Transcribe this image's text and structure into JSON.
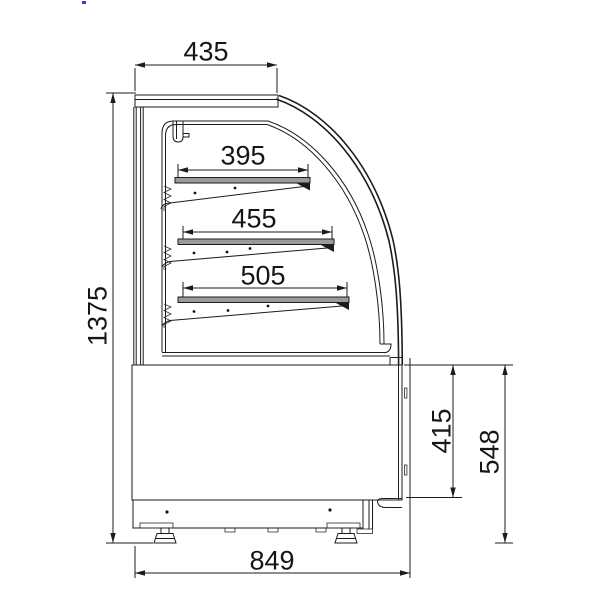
{
  "drawing": {
    "title": "display-cabinet-side-elevation",
    "description": "Technical side-view line drawing of a curved-glass refrigerated display cabinet with three shelves, base body, plinth and adjustable feet, fully dimensioned",
    "units_implied": "mm",
    "dimensions": {
      "top_depth": {
        "label": "435",
        "orientation": "horizontal",
        "location": "top of canopy"
      },
      "shelf_top": {
        "label": "395",
        "orientation": "horizontal",
        "location": "upper shelf depth"
      },
      "shelf_middle": {
        "label": "455",
        "orientation": "horizontal",
        "location": "middle shelf depth"
      },
      "shelf_bottom": {
        "label": "505",
        "orientation": "horizontal",
        "location": "lower shelf depth"
      },
      "overall_height": {
        "label": "1375",
        "orientation": "vertical",
        "location": "left side overall height"
      },
      "body_inner_height": {
        "label": "415",
        "orientation": "vertical",
        "location": "right side body height"
      },
      "base_height": {
        "label": "548",
        "orientation": "vertical",
        "location": "right side height to ground"
      },
      "overall_depth": {
        "label": "849",
        "orientation": "horizontal",
        "location": "bottom overall depth"
      }
    },
    "colors": {
      "line": "#1c1c1c",
      "shelf_fill": "#9a9a9a",
      "background": "#ffffff",
      "artifact_marker": "#3a3acc"
    }
  }
}
